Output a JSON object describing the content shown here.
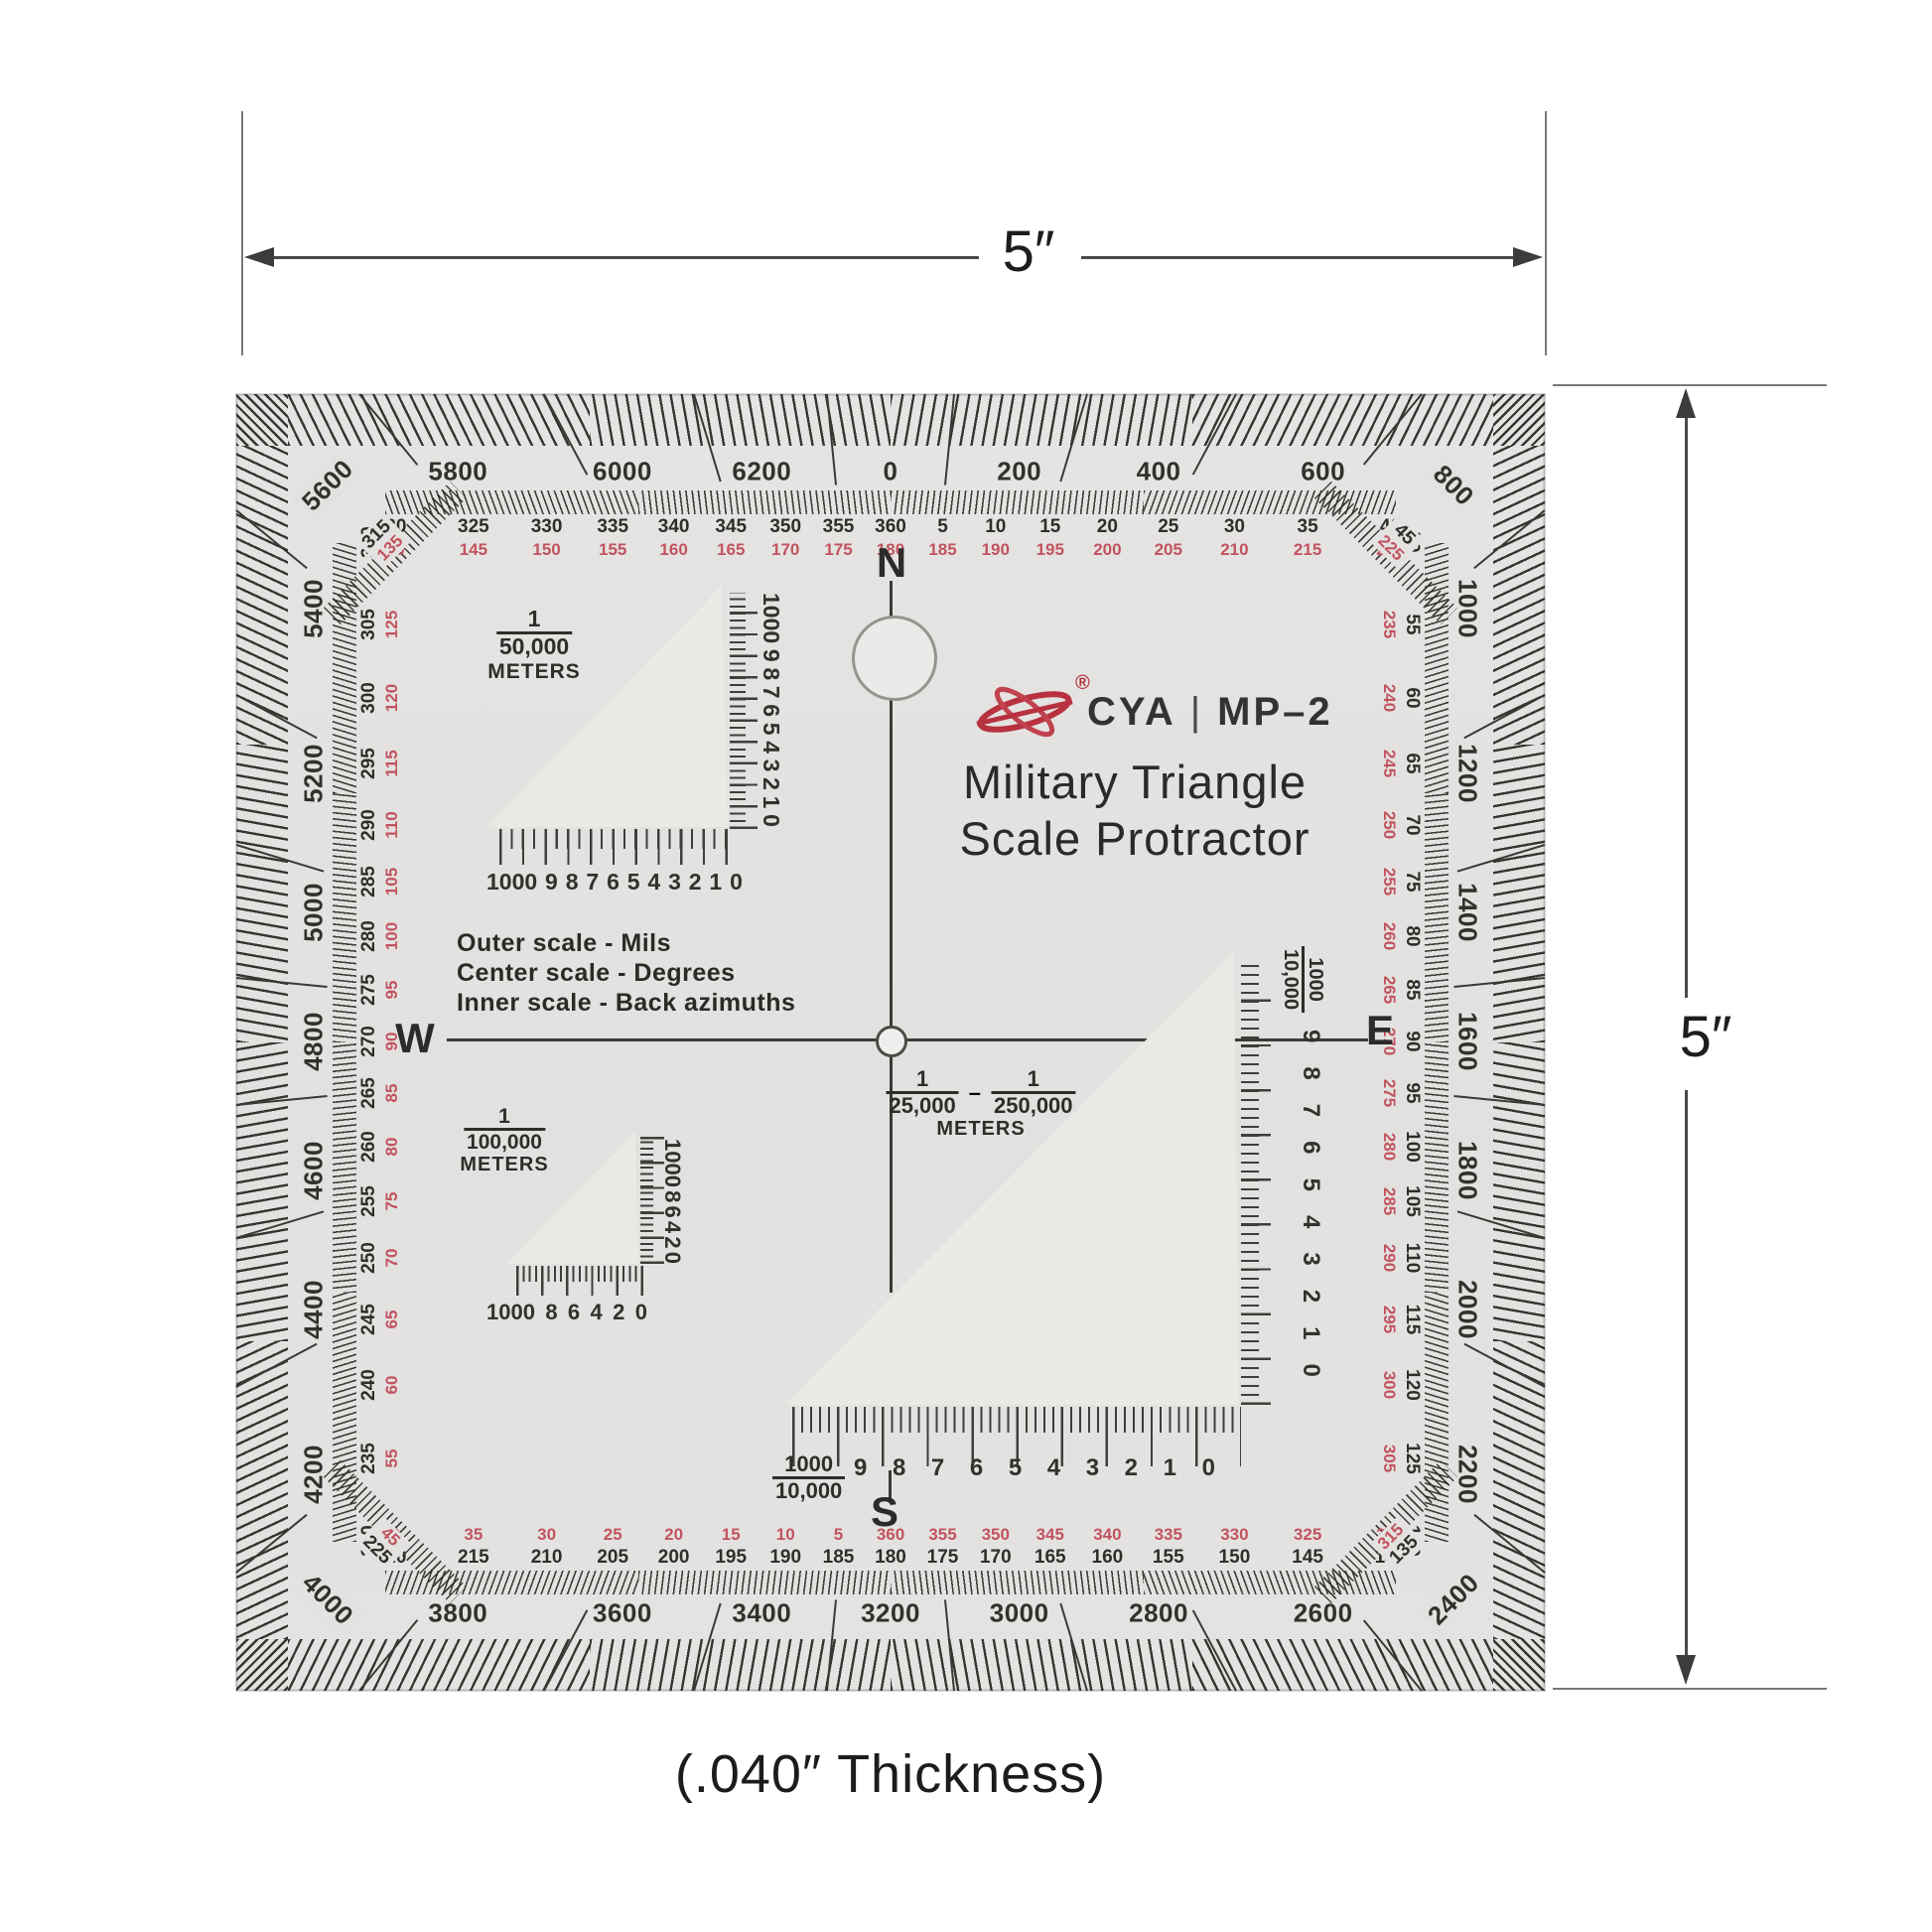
{
  "annotations": {
    "width_label": "5″",
    "height_label": "5″",
    "thickness_label": "(.040″ Thickness)"
  },
  "protractor": {
    "body_color": "#e3e2e0",
    "tick_color": "#3a3936",
    "back_azimuth_color": "#c2535f",
    "brand": {
      "name": "CYA",
      "separator": "|",
      "model": "MP–2",
      "registered": "®",
      "logo_color": "#b8313f"
    },
    "title": {
      "line1": "Military Triangle",
      "line2": "Scale Protractor"
    },
    "legend": {
      "line1": "Outer scale - Mils",
      "line2": "Center scale - Degrees",
      "line3": "Inner scale - Back azimuths"
    },
    "compass": {
      "n": "N",
      "s": "S",
      "e": "E",
      "w": "W"
    },
    "scales": {
      "mils": {
        "top": [
          "5800",
          "6000",
          "6200",
          "0",
          "200",
          "400",
          "600"
        ],
        "right": [
          "1000",
          "1200",
          "1400",
          "1600",
          "1800",
          "2000",
          "2200"
        ],
        "bottom": [
          "3800",
          "3600",
          "3400",
          "3200",
          "3000",
          "2800",
          "2600"
        ],
        "left": [
          "5400",
          "5200",
          "5000",
          "4800",
          "4600",
          "4400",
          "4200"
        ],
        "corners": {
          "tl": "5600",
          "tr": "800",
          "br": "2400",
          "bl": "4000"
        }
      },
      "degrees": {
        "top": {
          "deg": [
            "320",
            "325",
            "330",
            "335",
            "340",
            "345",
            "350",
            "355",
            "360",
            "5",
            "10",
            "15",
            "20",
            "25",
            "30",
            "35",
            "40"
          ],
          "back": [
            "140",
            "145",
            "150",
            "155",
            "160",
            "165",
            "170",
            "175",
            "180",
            "185",
            "190",
            "195",
            "200",
            "205",
            "210",
            "215",
            "220"
          ]
        },
        "right": {
          "deg": [
            "50",
            "55",
            "60",
            "65",
            "70",
            "75",
            "80",
            "85",
            "90",
            "95",
            "100",
            "105",
            "110",
            "115",
            "120",
            "125",
            "130"
          ],
          "back": [
            "230",
            "235",
            "240",
            "245",
            "250",
            "255",
            "260",
            "265",
            "270",
            "275",
            "280",
            "285",
            "290",
            "295",
            "300",
            "305",
            "310"
          ]
        },
        "bottom": {
          "deg": [
            "220",
            "215",
            "210",
            "205",
            "200",
            "195",
            "190",
            "185",
            "180",
            "175",
            "170",
            "165",
            "160",
            "155",
            "150",
            "145",
            "140"
          ],
          "back": [
            "40",
            "35",
            "30",
            "25",
            "20",
            "15",
            "10",
            "5",
            "360",
            "355",
            "350",
            "345",
            "340",
            "335",
            "330",
            "325",
            "320"
          ]
        },
        "left": {
          "deg": [
            "310",
            "305",
            "300",
            "295",
            "290",
            "285",
            "280",
            "275",
            "270",
            "265",
            "260",
            "255",
            "250",
            "245",
            "240",
            "235",
            "230"
          ],
          "back": [
            "130",
            "125",
            "120",
            "115",
            "110",
            "105",
            "100",
            "95",
            "90",
            "85",
            "80",
            "75",
            "70",
            "65",
            "60",
            "55",
            "50"
          ]
        },
        "corners": {
          "tl": {
            "deg": "315",
            "back": "135"
          },
          "tr": {
            "deg": "45",
            "back": "225"
          },
          "br": {
            "deg": "135",
            "back": "315"
          },
          "bl": {
            "deg": "225",
            "back": "45"
          }
        }
      }
    },
    "rulers": {
      "r50000": {
        "num": "1",
        "den": "50,000",
        "unit": "METERS",
        "bottom": [
          "1000",
          "9",
          "8",
          "7",
          "6",
          "5",
          "4",
          "3",
          "2",
          "1",
          "0"
        ],
        "right": [
          "0",
          "1",
          "2",
          "3",
          "4",
          "5",
          "6",
          "7",
          "8",
          "9",
          "1000"
        ]
      },
      "r100000": {
        "num": "1",
        "den": "100,000",
        "unit": "METERS",
        "bottom": [
          "1000",
          "8",
          "6",
          "4",
          "2",
          "0"
        ],
        "right": [
          "0",
          "2",
          "4",
          "6",
          "8",
          "1000"
        ]
      },
      "r25000": {
        "num1": "1",
        "den1": "25,000",
        "dash": "–",
        "num2": "1",
        "den2": "250,000",
        "unit": "METERS",
        "bottom_frac": {
          "num": "1000",
          "den": "10,000"
        },
        "bottom": [
          "9",
          "8",
          "7",
          "6",
          "5",
          "4",
          "3",
          "2",
          "1",
          "0"
        ],
        "right_frac": {
          "num": "1000",
          "den": "10,000"
        },
        "right": [
          "0",
          "1",
          "2",
          "3",
          "4",
          "5",
          "6",
          "7",
          "8",
          "9"
        ]
      }
    }
  }
}
